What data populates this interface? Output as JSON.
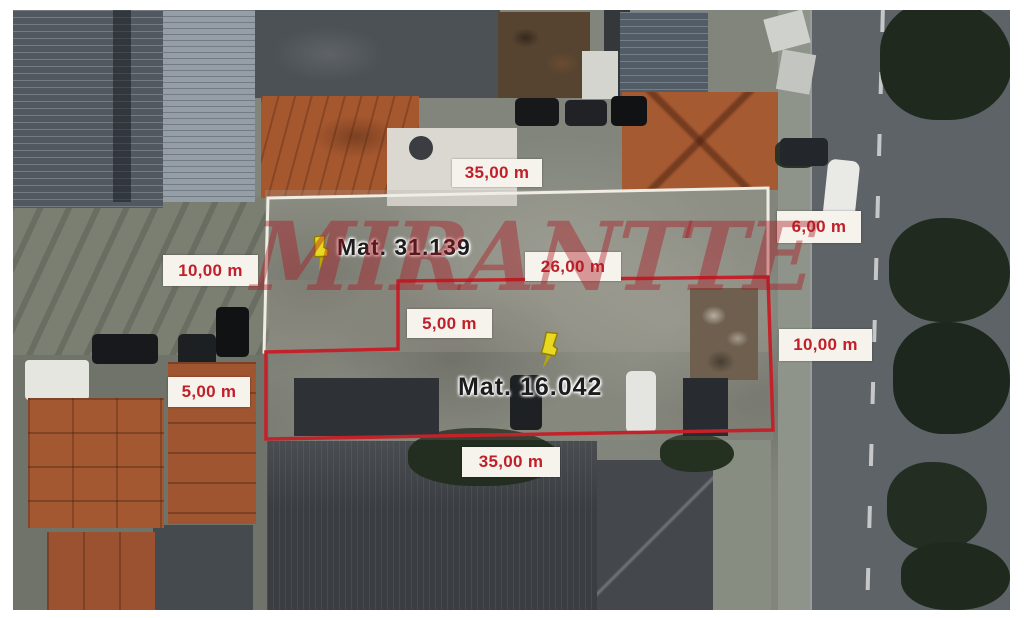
{
  "image": {
    "description": "Aerial satellite photo of two urban lots outlined for sale",
    "watermark": {
      "text": "MIRANTTE",
      "color": "#ac1822"
    }
  },
  "lots": [
    {
      "id": "lot-1",
      "label": "Mat. 31.139",
      "outline_color": "#efede4"
    },
    {
      "id": "lot-2",
      "label": "Mat. 16.042",
      "outline_color": "#c3222a"
    }
  ],
  "measurements": [
    {
      "id": "top-width",
      "text": "35,00 m"
    },
    {
      "id": "right-frontage",
      "text": "6,00 m"
    },
    {
      "id": "left-side-top",
      "text": "10,00 m"
    },
    {
      "id": "inner-width",
      "text": "26,00 m"
    },
    {
      "id": "step-depth",
      "text": "5,00 m"
    },
    {
      "id": "right-side",
      "text": "10,00 m"
    },
    {
      "id": "left-step",
      "text": "5,00 m"
    },
    {
      "id": "bottom-width",
      "text": "35,00 m"
    }
  ],
  "colors": {
    "annotation_red": "#c3222a",
    "label_bg": "#f6f3ec",
    "lot1_outline": "#efede4",
    "pushpin_yellow": "#e8d820",
    "road_gray": "#5e6367",
    "terracotta": "#a5582f"
  }
}
